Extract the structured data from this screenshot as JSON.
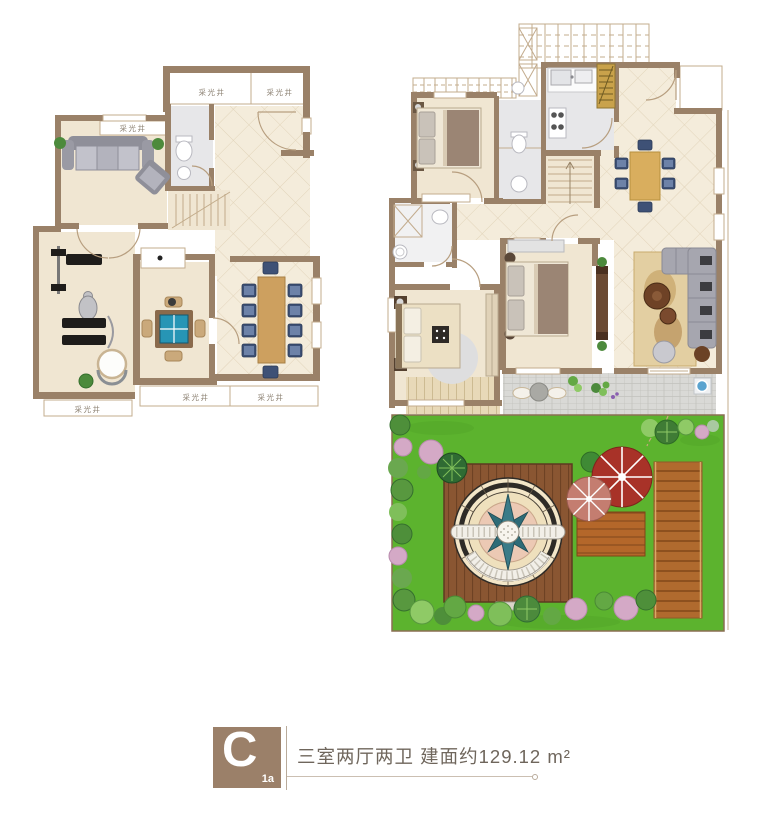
{
  "legend": {
    "unit_letter": "C",
    "unit_variant": "1a",
    "summary": "三室两厅两卫  建面约129.12 m²"
  },
  "labels": {
    "light_well_top_a": "采光井",
    "light_well_top_b": "采光井",
    "light_well_living": "采光井",
    "light_well_bottom_a": "采光井",
    "light_well_bottom_b": "采光井",
    "light_well_bottom_c": "采光井"
  },
  "colors": {
    "wall": "#9a8168",
    "wallLight": "#c3ac8e",
    "arcColor": "#b79e7f",
    "floorWood": "#f0e6d2",
    "floorTile": "#f4ecdb",
    "tileLine": "#e2d4ba",
    "bathFloor": "#e7e7e9",
    "labelText": "#8a7f70",
    "black": "#1f1d1b",
    "chairNavy": "#3e5176",
    "chairLight": "#6d82a8",
    "mahjongTeal": "#2795b5",
    "woodTable": "#cda05f",
    "grass": "#5cb32e",
    "grassLine": "#4ea026",
    "deckDark": "#8a5632",
    "deckLine": "#6e4224",
    "boardwalk": "#b06a2e",
    "boardLine": "#7e4517",
    "smallDeck": "#b4672a",
    "smallDeckLine": "#8a4c1e",
    "plankLight": "#e8d9b8",
    "plankLightLine": "#cdbb92",
    "paver": "#d9d9d6",
    "paverLine": "#c2c2bd",
    "umbrellaRed": "#a83228",
    "umbrellaPink": "#c47d70",
    "goldStair": "#c9a24b",
    "tvBrown": "#6b4a33",
    "rugTan": "#e3cfa2",
    "legendBrown": "#9b8069",
    "legendText": "#6f665c",
    "legendLine": "#cbbfb2"
  }
}
